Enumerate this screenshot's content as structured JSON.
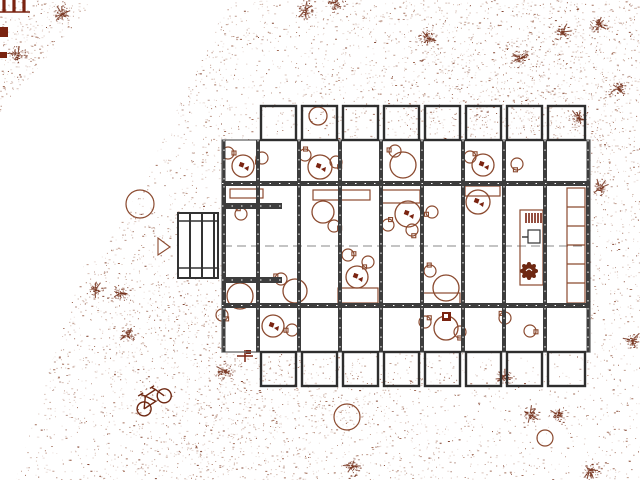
{
  "canvas": {
    "width": 640,
    "height": 480,
    "background": "#ffffff"
  },
  "palette": {
    "bg": "#ffffff",
    "ink": "#8b4a2f",
    "ink_dark": "#6e2812",
    "maroon": "#7a2310",
    "wall": "#3d3d3d",
    "balcony_line": "#2e2e2e",
    "slab_line": "#666666",
    "dash_line": "#888888"
  },
  "ground": {
    "dot_count": 16000,
    "seed": 42,
    "white_wedge": [
      [
        96,
        0
      ],
      [
        228,
        0
      ],
      [
        206,
        52
      ],
      [
        176,
        112
      ],
      [
        140,
        188
      ],
      [
        103,
        252
      ],
      [
        84,
        266
      ],
      [
        50,
        368
      ],
      [
        16,
        480
      ],
      [
        0,
        480
      ],
      [
        0,
        112
      ]
    ]
  },
  "building": {
    "slab": {
      "x": 222,
      "y": 140,
      "w": 368,
      "h": 212
    },
    "walls_x": [
      224,
      258,
      299,
      340,
      381,
      422,
      463,
      504,
      545,
      588
    ],
    "hwall_y": [
      183.5,
      305.5
    ],
    "strips": {
      "top": [
        140,
        181
      ],
      "mid": [
        186,
        303
      ],
      "bot": [
        308,
        352
      ]
    },
    "centerline_y": 246,
    "balcony": {
      "top_y": [
        106,
        140
      ],
      "bot_y": [
        352,
        386
      ],
      "inset": 3
    },
    "entry_stubs": [
      [
        222,
        203,
        60,
        6
      ],
      [
        222,
        277,
        60,
        6
      ]
    ],
    "stair": {
      "x": 178,
      "y": 213,
      "w": 40,
      "h": 65,
      "rail_ys": [
        221,
        268
      ],
      "bar_xs": [
        190,
        202,
        214
      ]
    }
  },
  "interior": {
    "rects": [
      [
        230,
        189,
        33,
        9
      ],
      [
        313,
        190,
        57,
        10
      ],
      [
        381,
        190,
        39,
        13
      ],
      [
        465,
        186,
        35,
        10
      ],
      [
        338,
        288,
        40,
        15
      ],
      [
        423,
        293,
        37,
        12
      ]
    ],
    "kitchen": {
      "counter": [
        520,
        210,
        23,
        75
      ],
      "stove": [
        526,
        213,
        15,
        10
      ],
      "sink": [
        528,
        230,
        12,
        13
      ],
      "plant": [
        529,
        271,
        7
      ]
    },
    "shelf": {
      "rect": [
        567,
        188,
        18,
        115
      ],
      "divider_ys": [
        207,
        226,
        245,
        264,
        283
      ]
    },
    "tables": [
      [
        243,
        166,
        11,
        1
      ],
      [
        320,
        167,
        12,
        1
      ],
      [
        403,
        165,
        13,
        0
      ],
      [
        483,
        165,
        11,
        1
      ],
      [
        318,
        116,
        9,
        0
      ],
      [
        323,
        212,
        11,
        0
      ],
      [
        408,
        214,
        13,
        1
      ],
      [
        478,
        202,
        12,
        1
      ],
      [
        295,
        291,
        12,
        0
      ],
      [
        240,
        296,
        13,
        0
      ],
      [
        357,
        277,
        11,
        1
      ],
      [
        446,
        288,
        13,
        0
      ],
      [
        273,
        326,
        11,
        1
      ],
      [
        446,
        328,
        12,
        0
      ]
    ],
    "chairs": [
      [
        228,
        153
      ],
      [
        262,
        158
      ],
      [
        305,
        155
      ],
      [
        336,
        162
      ],
      [
        395,
        151
      ],
      [
        470,
        157
      ],
      [
        517,
        164
      ],
      [
        241,
        214
      ],
      [
        334,
        226
      ],
      [
        432,
        212
      ],
      [
        388,
        225
      ],
      [
        412,
        230
      ],
      [
        281,
        279
      ],
      [
        348,
        255
      ],
      [
        368,
        262
      ],
      [
        430,
        271
      ],
      [
        222,
        315
      ],
      [
        292,
        330
      ],
      [
        425,
        322
      ],
      [
        460,
        332
      ],
      [
        505,
        318
      ],
      [
        530,
        331
      ]
    ],
    "dark_box": [
      442,
      312,
      9,
      9
    ]
  },
  "site": {
    "shrubs": [
      [
        18,
        55
      ],
      [
        62,
        14
      ],
      [
        88,
        50
      ],
      [
        305,
        10
      ],
      [
        336,
        4
      ],
      [
        428,
        38
      ],
      [
        520,
        58
      ],
      [
        562,
        32
      ],
      [
        598,
        25
      ],
      [
        618,
        88
      ],
      [
        600,
        188
      ],
      [
        578,
        118
      ],
      [
        95,
        290
      ],
      [
        120,
        293
      ],
      [
        127,
        334
      ],
      [
        225,
        371
      ],
      [
        505,
        378
      ],
      [
        530,
        415
      ],
      [
        558,
        415
      ],
      [
        590,
        470
      ],
      [
        352,
        466
      ],
      [
        632,
        340
      ]
    ],
    "trees": [
      [
        140,
        204,
        14
      ],
      [
        347,
        417,
        13
      ],
      [
        545,
        438,
        8
      ]
    ],
    "triangle": [
      [
        158,
        238
      ],
      [
        158,
        255
      ],
      [
        170,
        247
      ]
    ],
    "bicycle": {
      "x": 152,
      "y": 399,
      "rot": -33
    },
    "plus_marker": {
      "x": 245,
      "y": 356
    },
    "corner_bars": {
      "xs": [
        4,
        14,
        24
      ],
      "y1": 0,
      "y2": 12
    },
    "corner_squares": [
      [
        0,
        27,
        8,
        10
      ],
      [
        0,
        52,
        7,
        6
      ]
    ]
  }
}
